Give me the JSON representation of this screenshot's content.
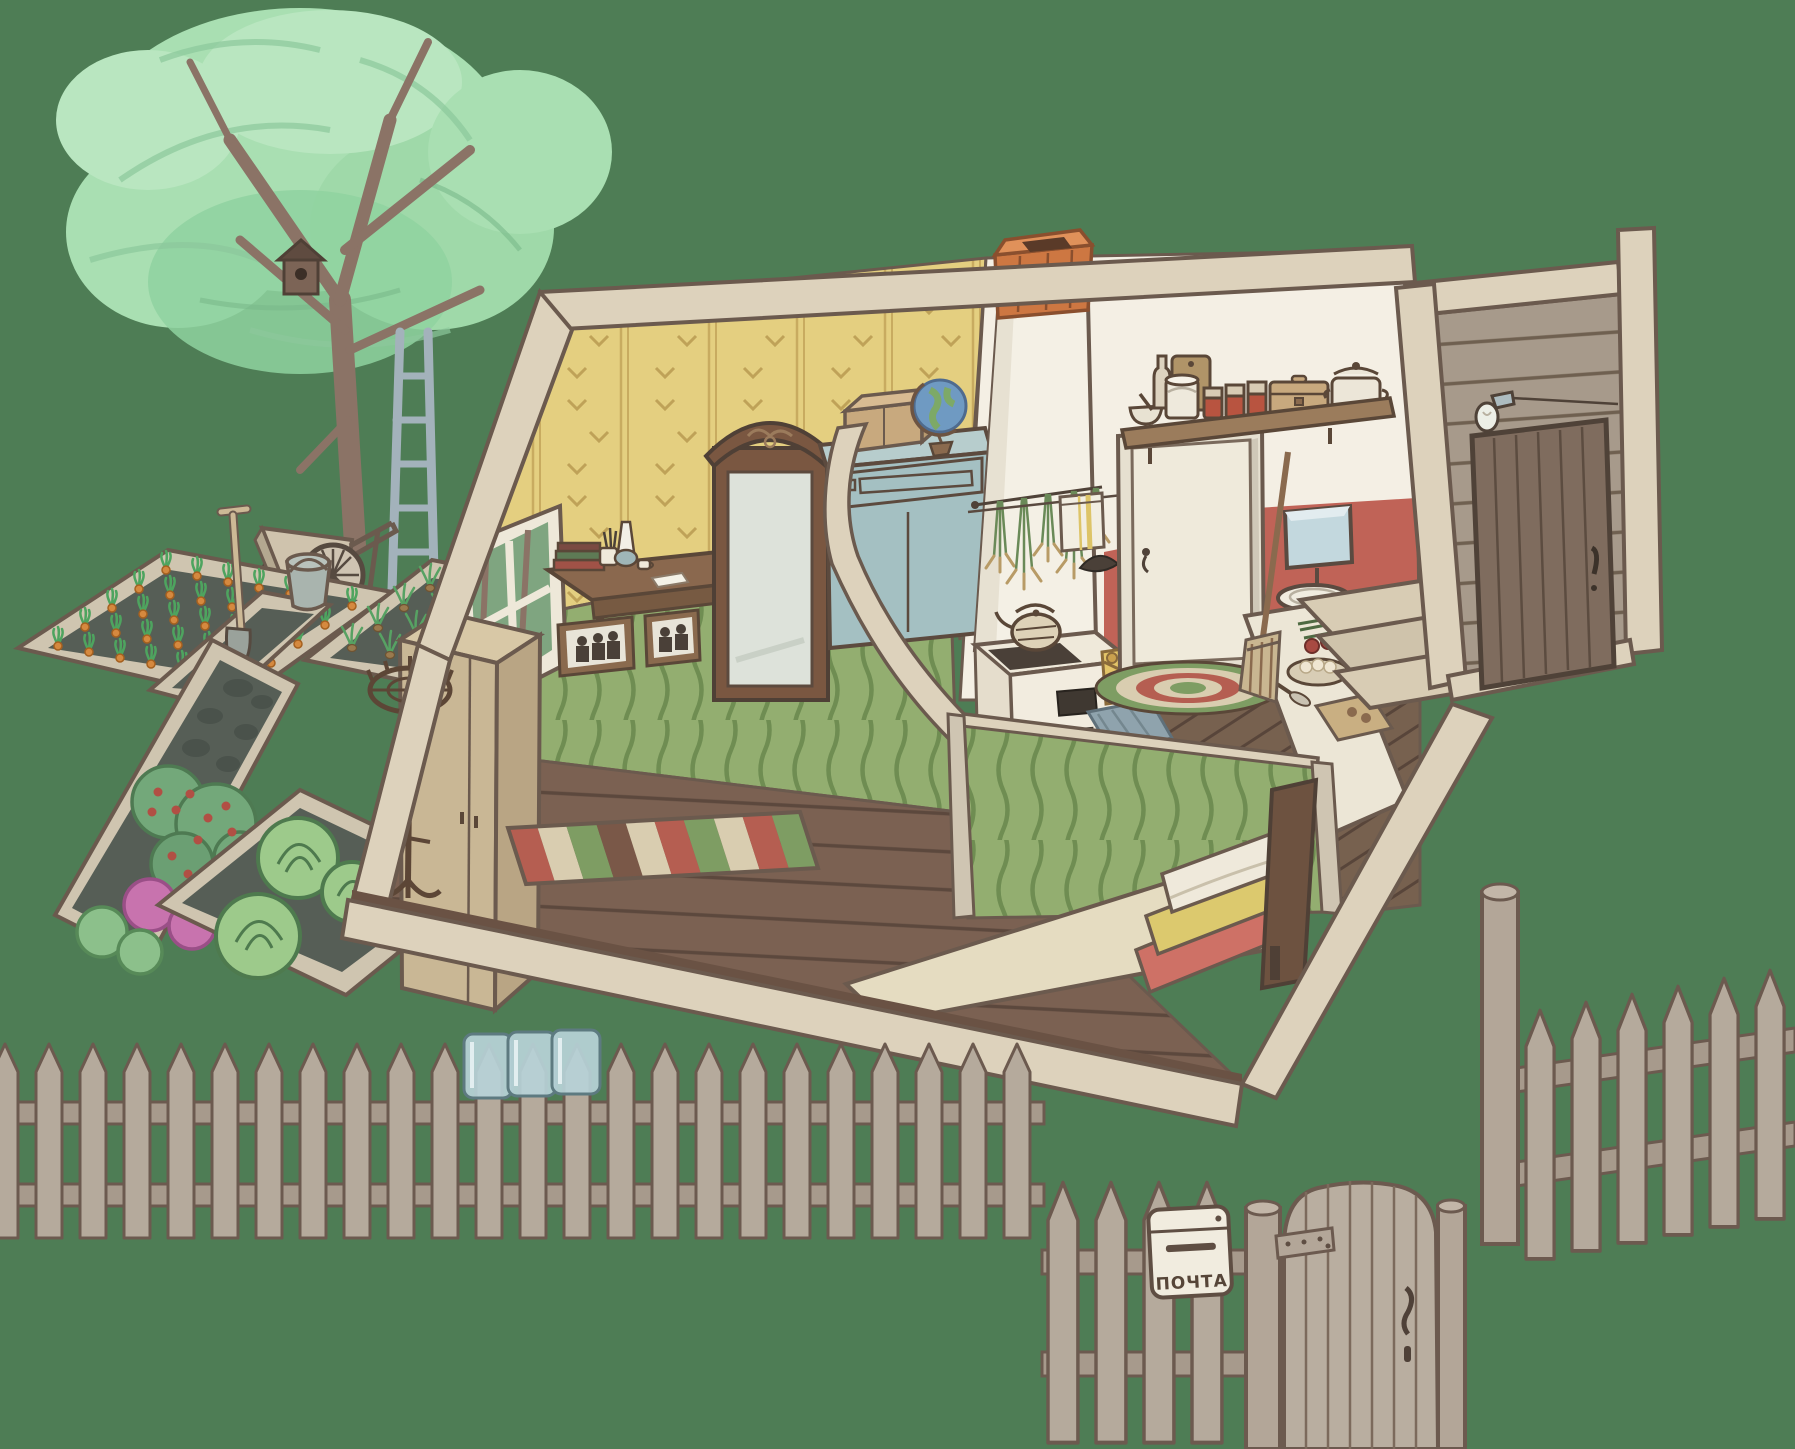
{
  "scene": {
    "name": "cutaway cottage with garden",
    "style": "hand-drawn storybook illustration",
    "mailbox": {
      "label": "ПОЧТА"
    },
    "palette": {
      "background_green": "#4e7d55",
      "outline_brown": "#6b5a4e",
      "wall_cut_edge": "#ddd2bc",
      "wallpaper_yellow": "#e4cf80",
      "wainscot_green": "#93ae70",
      "floor_brown": "#7b6152",
      "kitchen_wall_white": "#f4efe4",
      "kitchen_wall_red": "#c06357",
      "chimney_brick": "#cd7742",
      "porch_plank_grey": "#a79a8b",
      "porch_door_brown": "#7f6c5e",
      "fence_wood": "#b5aa9c",
      "mailbox_white": "#f1ecdf",
      "glass_jar_blue": "#b7d2d8",
      "dresser_blue": "#a4c0c2",
      "cardboard_tan": "#c8a97e",
      "bed_blanket_cream": "#e5dcc1",
      "blanket_red": "#ce7166",
      "blanket_yellow": "#dcc96e",
      "tree_foliage": "#a9dfb2",
      "tree_trunk": "#8b7366",
      "soil_dark": "#565e56",
      "carrot_orange": "#d5893f",
      "cabbage_green": "#9dca8b",
      "berry_red": "#b14f44",
      "lettuce_pink": "#c873ae",
      "rug_red": "#b55e51",
      "rug_green": "#7e9d63",
      "rug_cream": "#d9cdb0"
    },
    "objects": {
      "outdoor": [
        "tree",
        "birdhouse",
        "ladder",
        "wheelbarrow",
        "shovel",
        "bucket",
        "carrot-bed",
        "onion-bed",
        "empty-bed",
        "berry-lettuce-bed",
        "cabbage-bed"
      ],
      "living_room": [
        "window",
        "writing-desk",
        "books",
        "oil-lamp",
        "mirror-wardrobe",
        "blue-dresser",
        "cardboard-box",
        "globe",
        "family-photos",
        "tall-cabinet",
        "coat-rack",
        "striped-rug",
        "bed"
      ],
      "kitchen": [
        "chimney-stove",
        "kettle",
        "firewood",
        "dried-herbs",
        "clothesline-towel",
        "interior-door",
        "round-rug",
        "washstand",
        "wash-basin",
        "kitchen-table",
        "food",
        "broom",
        "kitchen-shelf",
        "shelf-jars",
        "milk-can",
        "cooking-pot",
        "chest-box",
        "floor-mat"
      ],
      "porch": [
        "entry-door",
        "light-bulb",
        "steps"
      ],
      "fence": [
        "pickets",
        "gate",
        "gate-post",
        "mail-box",
        "glass-jars"
      ]
    }
  }
}
